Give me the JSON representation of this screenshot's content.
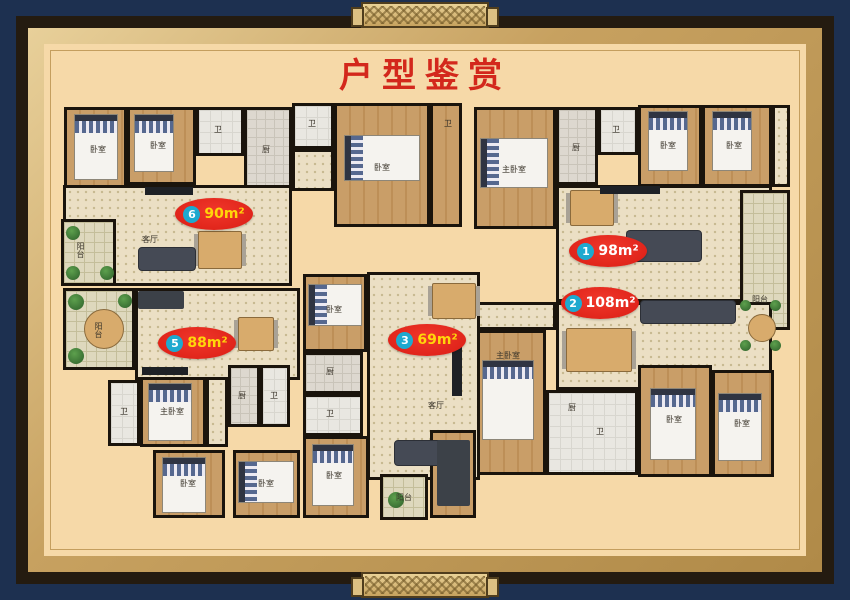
{
  "title": {
    "text": "户型鉴赏"
  },
  "colors": {
    "frame_navy": "#1d3050",
    "frame_black": "#241b10",
    "frame_gold": "#c7a160",
    "mat_beige": "#f6d9a8",
    "title_red": "#d3281c",
    "badge_red": "#e8231d",
    "badge_circle_blue": "#1ea9cf",
    "badge_text_yellow": "#ffd60a",
    "badge_text_white": "#ffffff",
    "wall_black": "#1a140c"
  },
  "badges": [
    {
      "num": "6",
      "area": "90m²",
      "cx": 214,
      "cy": 214,
      "color": "#ffd60a"
    },
    {
      "num": "1",
      "area": "98m²",
      "cx": 608,
      "cy": 251,
      "color": "#ffffff"
    },
    {
      "num": "2",
      "area": "108m²",
      "cx": 600,
      "cy": 303,
      "color": "#ffffff"
    },
    {
      "num": "3",
      "area": "69m²",
      "cx": 427,
      "cy": 340,
      "color": "#ffd60a"
    },
    {
      "num": "5",
      "area": "88m²",
      "cx": 197,
      "cy": 343,
      "color": "#ffd60a"
    }
  ],
  "plan": {
    "rooms": [
      {
        "id": "u6-bed-a",
        "x": 64,
        "y": 107,
        "w": 63,
        "h": 85,
        "f": "wood"
      },
      {
        "id": "u6-bed-b",
        "x": 127,
        "y": 107,
        "w": 69,
        "h": 78,
        "f": "wood"
      },
      {
        "id": "u6-bath",
        "x": 196,
        "y": 107,
        "w": 48,
        "h": 49,
        "f": "bath"
      },
      {
        "id": "u6-kitchen",
        "x": 244,
        "y": 107,
        "w": 48,
        "h": 82,
        "f": "tile"
      },
      {
        "id": "u6-living",
        "x": 63,
        "y": 185,
        "w": 229,
        "h": 101,
        "f": "dots"
      },
      {
        "id": "u6-balcony",
        "x": 61,
        "y": 219,
        "w": 55,
        "h": 67,
        "f": "balc"
      },
      {
        "id": "mid-bath-a",
        "x": 292,
        "y": 103,
        "w": 42,
        "h": 46,
        "f": "bath"
      },
      {
        "id": "mid-hall",
        "x": 292,
        "y": 149,
        "w": 42,
        "h": 42,
        "f": "dots"
      },
      {
        "id": "mid-bedroom",
        "x": 334,
        "y": 103,
        "w": 96,
        "h": 124,
        "f": "wood"
      },
      {
        "id": "mid-corridor",
        "x": 430,
        "y": 103,
        "w": 32,
        "h": 124,
        "f": "wood"
      },
      {
        "id": "u1-bed-a",
        "x": 474,
        "y": 107,
        "w": 82,
        "h": 122,
        "f": "wood"
      },
      {
        "id": "u1-kitchen",
        "x": 556,
        "y": 107,
        "w": 42,
        "h": 78,
        "f": "tile"
      },
      {
        "id": "u1-bath",
        "x": 598,
        "y": 107,
        "w": 40,
        "h": 48,
        "f": "bath"
      },
      {
        "id": "u1-bed-b",
        "x": 638,
        "y": 105,
        "w": 64,
        "h": 82,
        "f": "wood"
      },
      {
        "id": "u1-bed-c",
        "x": 702,
        "y": 105,
        "w": 70,
        "h": 82,
        "f": "wood"
      },
      {
        "id": "u1-closet",
        "x": 772,
        "y": 105,
        "w": 18,
        "h": 82,
        "f": "dots"
      },
      {
        "id": "u1-living",
        "x": 556,
        "y": 185,
        "w": 216,
        "h": 117,
        "f": "dots"
      },
      {
        "id": "u1-balcony",
        "x": 740,
        "y": 190,
        "w": 50,
        "h": 140,
        "f": "balc"
      },
      {
        "id": "u2-living",
        "x": 556,
        "y": 302,
        "w": 216,
        "h": 88,
        "f": "dots"
      },
      {
        "id": "u2-entry",
        "x": 474,
        "y": 302,
        "w": 82,
        "h": 28,
        "f": "dots"
      },
      {
        "id": "u2-master-bed",
        "x": 474,
        "y": 330,
        "w": 72,
        "h": 145,
        "f": "wood"
      },
      {
        "id": "u2-bath-block",
        "x": 546,
        "y": 390,
        "w": 92,
        "h": 85,
        "f": "bath"
      },
      {
        "id": "u2-bed-a",
        "x": 638,
        "y": 365,
        "w": 74,
        "h": 112,
        "f": "wood"
      },
      {
        "id": "u2-bed-b",
        "x": 712,
        "y": 370,
        "w": 62,
        "h": 107,
        "f": "wood"
      },
      {
        "id": "u3-bed-a",
        "x": 303,
        "y": 274,
        "w": 64,
        "h": 78,
        "f": "wood"
      },
      {
        "id": "u3-living",
        "x": 367,
        "y": 272,
        "w": 113,
        "h": 208,
        "f": "dots"
      },
      {
        "id": "u3-kitchen",
        "x": 303,
        "y": 352,
        "w": 60,
        "h": 42,
        "f": "tile"
      },
      {
        "id": "u3-bath",
        "x": 303,
        "y": 394,
        "w": 60,
        "h": 42,
        "f": "bath"
      },
      {
        "id": "u3-bed-b",
        "x": 303,
        "y": 436,
        "w": 66,
        "h": 82,
        "f": "wood"
      },
      {
        "id": "u3-balcony",
        "x": 380,
        "y": 474,
        "w": 48,
        "h": 46,
        "f": "balc"
      },
      {
        "id": "u3-store",
        "x": 430,
        "y": 430,
        "w": 46,
        "h": 88,
        "f": "wood"
      },
      {
        "id": "u5-balcony",
        "x": 63,
        "y": 288,
        "w": 72,
        "h": 82,
        "f": "balc"
      },
      {
        "id": "u5-living",
        "x": 135,
        "y": 288,
        "w": 165,
        "h": 92,
        "f": "dots"
      },
      {
        "id": "u5-bath-a",
        "x": 108,
        "y": 380,
        "w": 32,
        "h": 66,
        "f": "bath"
      },
      {
        "id": "u5-master-bed",
        "x": 140,
        "y": 377,
        "w": 66,
        "h": 70,
        "f": "wood"
      },
      {
        "id": "u5-corridor",
        "x": 206,
        "y": 377,
        "w": 22,
        "h": 70,
        "f": "dots"
      },
      {
        "id": "u5-kitchen",
        "x": 228,
        "y": 365,
        "w": 32,
        "h": 62,
        "f": "tile"
      },
      {
        "id": "u5-bath-b",
        "x": 260,
        "y": 365,
        "w": 30,
        "h": 62,
        "f": "bath"
      },
      {
        "id": "u5-bed-b",
        "x": 153,
        "y": 450,
        "w": 72,
        "h": 68,
        "f": "wood"
      },
      {
        "id": "u5-bed-c",
        "x": 233,
        "y": 450,
        "w": 67,
        "h": 68,
        "f": "wood"
      }
    ],
    "furniture": [
      {
        "t": "bed-v",
        "x": 74,
        "y": 114,
        "w": 44,
        "h": 66
      },
      {
        "t": "bed-v",
        "x": 134,
        "y": 114,
        "w": 40,
        "h": 58
      },
      {
        "t": "bed-h",
        "x": 344,
        "y": 135,
        "w": 76,
        "h": 46
      },
      {
        "t": "bed-h",
        "x": 480,
        "y": 138,
        "w": 68,
        "h": 50
      },
      {
        "t": "bed-v",
        "x": 648,
        "y": 111,
        "w": 40,
        "h": 60
      },
      {
        "t": "bed-v",
        "x": 712,
        "y": 111,
        "w": 40,
        "h": 60
      },
      {
        "t": "bed-v",
        "x": 482,
        "y": 360,
        "w": 52,
        "h": 80
      },
      {
        "t": "bed-v",
        "x": 650,
        "y": 388,
        "w": 46,
        "h": 72
      },
      {
        "t": "bed-v",
        "x": 718,
        "y": 393,
        "w": 44,
        "h": 68
      },
      {
        "t": "bed-h",
        "x": 308,
        "y": 284,
        "w": 54,
        "h": 42
      },
      {
        "t": "bed-v",
        "x": 312,
        "y": 444,
        "w": 42,
        "h": 62
      },
      {
        "t": "bed-v",
        "x": 148,
        "y": 383,
        "w": 44,
        "h": 58
      },
      {
        "t": "bed-v",
        "x": 162,
        "y": 457,
        "w": 44,
        "h": 56
      },
      {
        "t": "bed-h",
        "x": 238,
        "y": 461,
        "w": 56,
        "h": 42
      },
      {
        "t": "table",
        "x": 198,
        "y": 231,
        "w": 44,
        "h": 38
      },
      {
        "t": "table",
        "x": 570,
        "y": 190,
        "w": 44,
        "h": 36
      },
      {
        "t": "table",
        "x": 566,
        "y": 328,
        "w": 66,
        "h": 44
      },
      {
        "t": "table",
        "x": 432,
        "y": 283,
        "w": 44,
        "h": 36
      },
      {
        "t": "table",
        "x": 238,
        "y": 317,
        "w": 36,
        "h": 34
      },
      {
        "t": "round",
        "x": 84,
        "y": 309,
        "w": 40,
        "h": 40
      },
      {
        "t": "round",
        "x": 748,
        "y": 314,
        "w": 28,
        "h": 28
      },
      {
        "t": "sofa",
        "x": 138,
        "y": 247,
        "w": 58,
        "h": 24
      },
      {
        "t": "sofa",
        "x": 626,
        "y": 230,
        "w": 76,
        "h": 32
      },
      {
        "t": "sofa",
        "x": 640,
        "y": 300,
        "w": 96,
        "h": 24
      },
      {
        "t": "sofa",
        "x": 394,
        "y": 440,
        "w": 54,
        "h": 26
      },
      {
        "t": "desk",
        "x": 138,
        "y": 291,
        "w": 46,
        "h": 18
      },
      {
        "t": "desk",
        "x": 437,
        "y": 440,
        "w": 33,
        "h": 66
      },
      {
        "t": "tv",
        "x": 145,
        "y": 187,
        "w": 48,
        "h": 8
      },
      {
        "t": "tv",
        "x": 600,
        "y": 186,
        "w": 60,
        "h": 8
      },
      {
        "t": "tv",
        "x": 142,
        "y": 367,
        "w": 46,
        "h": 8
      },
      {
        "t": "tv",
        "x": 452,
        "y": 340,
        "w": 10,
        "h": 56
      },
      {
        "t": "plant",
        "x": 66,
        "y": 226,
        "w": 14,
        "h": 14
      },
      {
        "t": "plant",
        "x": 66,
        "y": 266,
        "w": 14,
        "h": 14
      },
      {
        "t": "plant",
        "x": 100,
        "y": 266,
        "w": 14,
        "h": 14
      },
      {
        "t": "plant",
        "x": 68,
        "y": 294,
        "w": 16,
        "h": 16
      },
      {
        "t": "plant",
        "x": 68,
        "y": 348,
        "w": 16,
        "h": 16
      },
      {
        "t": "plant",
        "x": 118,
        "y": 294,
        "w": 14,
        "h": 14
      },
      {
        "t": "plant",
        "x": 388,
        "y": 492,
        "w": 16,
        "h": 16
      },
      {
        "t": "plant",
        "x": 740,
        "y": 300,
        "w": 11,
        "h": 11
      },
      {
        "t": "plant",
        "x": 770,
        "y": 300,
        "w": 11,
        "h": 11
      },
      {
        "t": "plant",
        "x": 740,
        "y": 340,
        "w": 11,
        "h": 11
      },
      {
        "t": "plant",
        "x": 770,
        "y": 340,
        "w": 11,
        "h": 11
      }
    ],
    "labels": [
      {
        "t": "卧室",
        "x": 98,
        "y": 150
      },
      {
        "t": "卧室",
        "x": 158,
        "y": 146
      },
      {
        "t": "卫",
        "x": 218,
        "y": 130
      },
      {
        "t": "厨",
        "x": 266,
        "y": 150
      },
      {
        "t": "阳台",
        "x": 80,
        "y": 250,
        "v": true
      },
      {
        "t": "客厅",
        "x": 150,
        "y": 240
      },
      {
        "t": "卫",
        "x": 312,
        "y": 124
      },
      {
        "t": "卧室",
        "x": 382,
        "y": 168
      },
      {
        "t": "卫",
        "x": 448,
        "y": 124
      },
      {
        "t": "主卧室",
        "x": 514,
        "y": 170
      },
      {
        "t": "厨",
        "x": 576,
        "y": 148
      },
      {
        "t": "卫",
        "x": 616,
        "y": 130
      },
      {
        "t": "卧室",
        "x": 668,
        "y": 146
      },
      {
        "t": "卧室",
        "x": 734,
        "y": 146
      },
      {
        "t": "阳台",
        "x": 760,
        "y": 300
      },
      {
        "t": "客厅",
        "x": 436,
        "y": 406
      },
      {
        "t": "厨",
        "x": 330,
        "y": 372
      },
      {
        "t": "卫",
        "x": 330,
        "y": 414
      },
      {
        "t": "卧室",
        "x": 334,
        "y": 310
      },
      {
        "t": "卧室",
        "x": 334,
        "y": 476
      },
      {
        "t": "阳台",
        "x": 404,
        "y": 498
      },
      {
        "t": "主卧室",
        "x": 508,
        "y": 356
      },
      {
        "t": "卧室",
        "x": 674,
        "y": 420
      },
      {
        "t": "卧室",
        "x": 742,
        "y": 424
      },
      {
        "t": "卫",
        "x": 600,
        "y": 432
      },
      {
        "t": "厨",
        "x": 572,
        "y": 408
      },
      {
        "t": "阳台",
        "x": 98,
        "y": 330,
        "v": true
      },
      {
        "t": "主卧室",
        "x": 172,
        "y": 412
      },
      {
        "t": "卫",
        "x": 124,
        "y": 412
      },
      {
        "t": "卧室",
        "x": 188,
        "y": 484
      },
      {
        "t": "卧室",
        "x": 266,
        "y": 484
      },
      {
        "t": "卫",
        "x": 274,
        "y": 396
      },
      {
        "t": "厨",
        "x": 242,
        "y": 396
      }
    ]
  }
}
